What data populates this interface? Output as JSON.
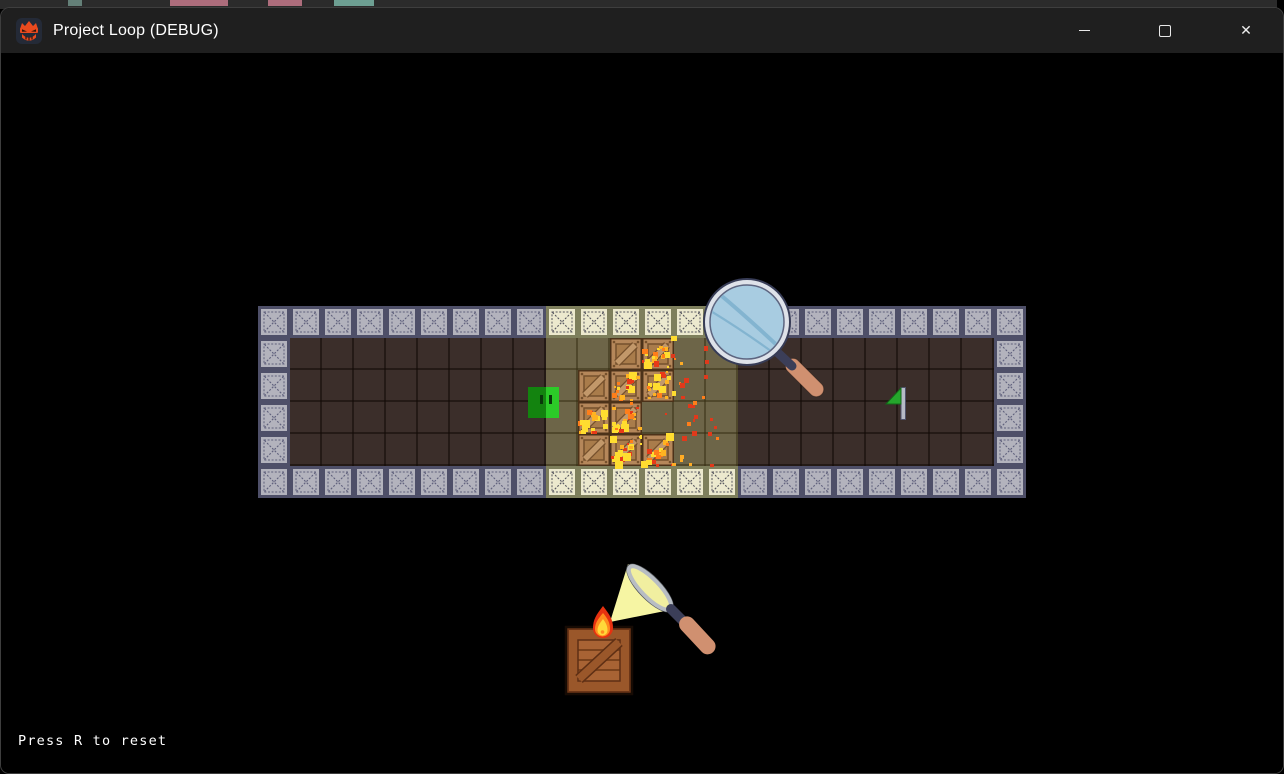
{
  "background_app": {
    "strip_color": "#2b2b2b",
    "code_fragments": [
      {
        "x": 68,
        "w": 14,
        "color": "#6f8f86"
      },
      {
        "x": 170,
        "w": 58,
        "color": "#c4798b"
      },
      {
        "x": 268,
        "w": 34,
        "color": "#c4798b"
      },
      {
        "x": 334,
        "w": 40,
        "color": "#79b4a4"
      }
    ]
  },
  "window": {
    "title": "Project Loop (DEBUG)",
    "app_icon": "ninja-face-icon",
    "controls": {
      "minimize": "minimize",
      "maximize": "maximize",
      "close": "close",
      "close_glyph": "✕"
    }
  },
  "hud": {
    "reset_hint": "Press R to reset",
    "hint_x": 18,
    "hint_y": 733
  },
  "game": {
    "map": {
      "left": 258,
      "top": 306,
      "tile": 32,
      "cols": 24,
      "rows": 6,
      "lit_col_start": 9,
      "lit_col_end": 14
    },
    "crates": [
      {
        "col": 11,
        "row": 0,
        "burning": false
      },
      {
        "col": 12,
        "row": 0,
        "burning": true
      },
      {
        "col": 10,
        "row": 1,
        "burning": false
      },
      {
        "col": 11,
        "row": 1,
        "burning": true
      },
      {
        "col": 12,
        "row": 1,
        "burning": true
      },
      {
        "col": 10,
        "row": 2,
        "burning": true
      },
      {
        "col": 11,
        "row": 2,
        "burning": true
      },
      {
        "col": 10,
        "row": 3,
        "burning": false
      },
      {
        "col": 11,
        "row": 3,
        "burning": true
      },
      {
        "col": 12,
        "row": 3,
        "burning": true
      }
    ],
    "player": {
      "x": 528,
      "y": 387,
      "w": 31,
      "h": 31
    },
    "flag": {
      "x": 884,
      "y": 386
    },
    "magnifier": {
      "x": 687,
      "y": 262
    },
    "burning_glass_scene": {
      "x": 552,
      "y": 548
    },
    "ember_field": {
      "x": 664,
      "y": 336,
      "w": 52,
      "h": 134,
      "count": 30
    },
    "colors": {
      "floor_dark": "#3b2e2a",
      "floor_dark_line": "rgba(18,10,6,0.55)",
      "floor_lit": "#6d6548",
      "floor_lit_line": "rgba(52,44,16,0.5)",
      "tile_fill": "#b3b3bd",
      "tile_frame": "#4e4f68",
      "tile_line": "#5f607c",
      "tile_lit_fill": "#ece9ce",
      "tile_lit_frame": "#7e7f5c",
      "tile_lit_line": "#56565e",
      "crate_outline": "#4c3219",
      "crate_frame": "#b5875a",
      "crate_inner": "#a97c4b",
      "crate_diag": "#c2986a",
      "crate_seam": "#75502c",
      "player_dark": "#13830f",
      "player_bright": "#2ccb28",
      "player_eye": "#09380a",
      "flag_green": "#25a62c",
      "flag_pole": "#b6bac6",
      "flag_pole_edge": "#50536b",
      "lens_blue": "#a8cce1",
      "lens_rim": "#dee2e9",
      "lens_ring": "#373c56",
      "lens_streak": "#83b4d0",
      "lens_crescent": "#cbe6f2",
      "handle_salmon": "#d09070",
      "handle_navy": "#3b3e58",
      "cone_yellow": "#f6f5a3",
      "scene_lens_fill": "#f1efa0",
      "scene_lens_rim": "#b8bdc3",
      "scene_lens_edge": "#53575d",
      "flame_red": "#e63110",
      "flame_orange": "#ff8c1e",
      "flame_yellow": "#ffd93a",
      "big_crate_outline": "#160b04",
      "big_crate_dark": "#6b3517",
      "big_crate_rail": "#9a572a",
      "big_crate_inner": "#a86334",
      "big_crate_seam": "#7a421c",
      "fire_palette": [
        "#ffdd30",
        "#ffb321",
        "#ff7e1a",
        "#e83a18"
      ],
      "ember_palette": [
        "#e0391b",
        "#ff7e1a",
        "#ffac25"
      ]
    }
  }
}
